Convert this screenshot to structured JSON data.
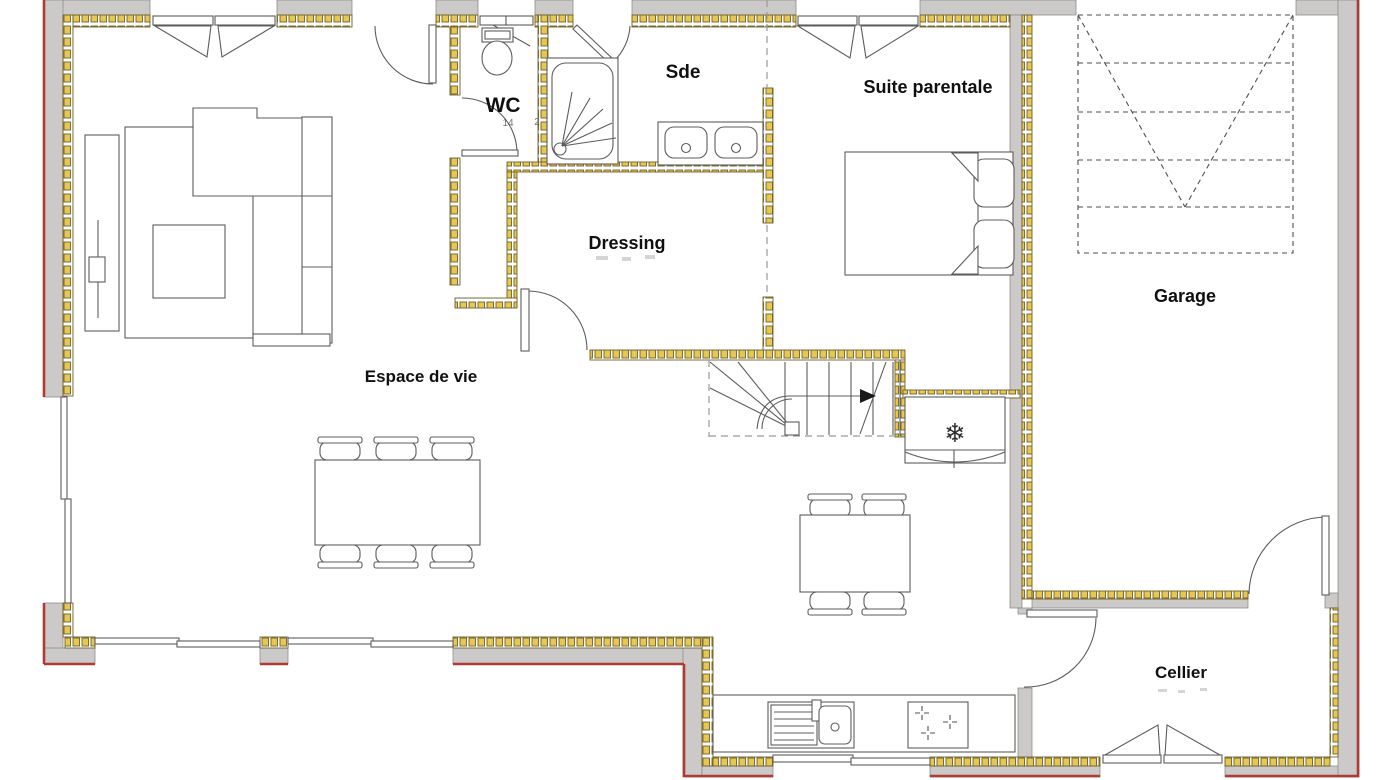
{
  "plan": {
    "type": "floor-plan",
    "rooms": [
      {
        "id": "wc",
        "label": "WC"
      },
      {
        "id": "sde",
        "label": "Sde"
      },
      {
        "id": "suite_parentale",
        "label": "Suite parentale"
      },
      {
        "id": "dressing",
        "label": "Dressing"
      },
      {
        "id": "espace_de_vie",
        "label": "Espace de vie"
      },
      {
        "id": "garage",
        "label": "Garage"
      },
      {
        "id": "cellier",
        "label": "Cellier"
      }
    ],
    "annotations": {
      "wc_dim_left": "14",
      "wc_dim_right": "2"
    },
    "symbols": {
      "fridge_snowflake": "❄"
    },
    "colors": {
      "wall_gray": "#cbcac8",
      "wall_edge": "#8e8d8b",
      "outline_red": "#b03a33",
      "insulation_fill": "#e8c653",
      "insulation_edge": "#6e6128",
      "line": "#5c5c5c",
      "text": "#101010"
    }
  }
}
